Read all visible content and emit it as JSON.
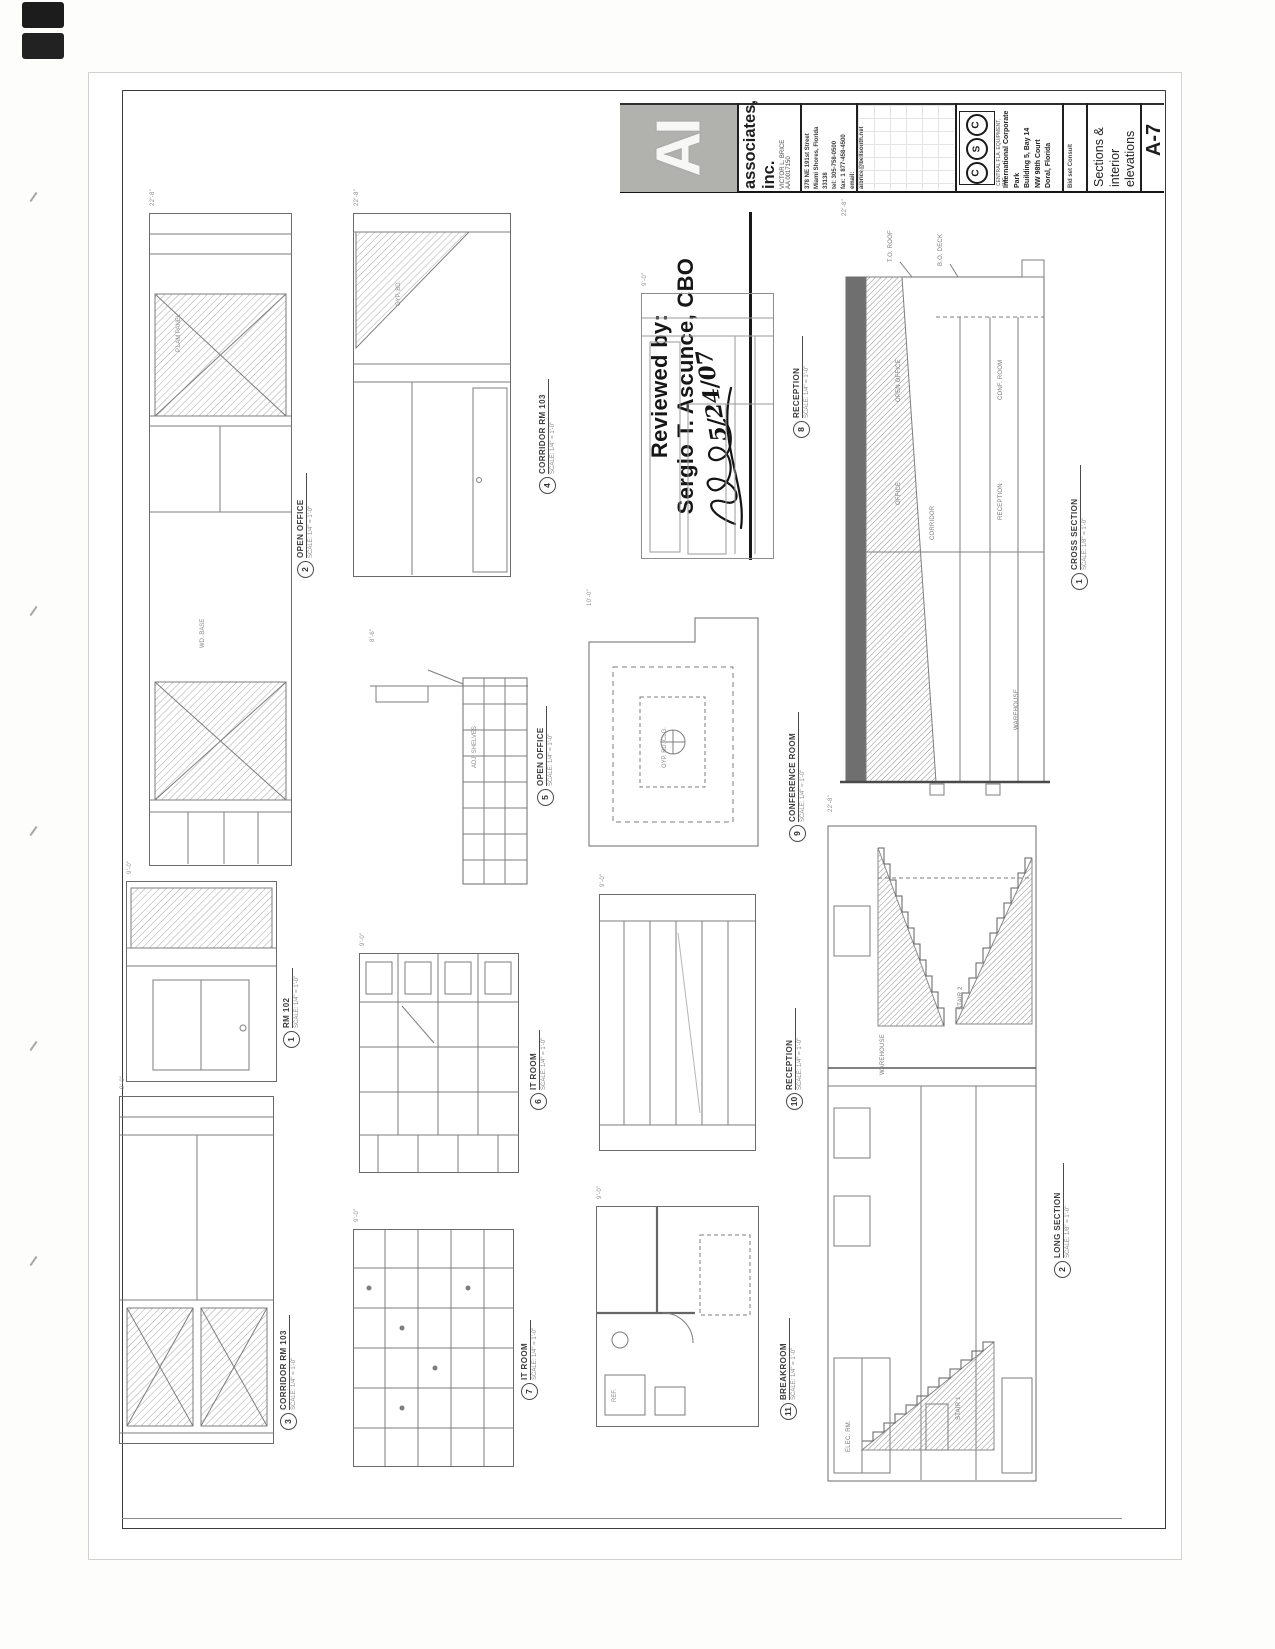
{
  "sheet": {
    "sheet_number": "A-7",
    "sheet_title_lines": [
      "Sections &",
      "interior",
      "elevations"
    ],
    "issue_note": "Bid set  Consult",
    "firm": {
      "logo": "AI",
      "name_top": "associates,",
      "name_bottom": "inc.",
      "principal": "VICTOR L. BRICE",
      "license": "AA 0017150",
      "address_lines": [
        "378 NE 191st Street",
        "Miami Shores, Florida",
        "33138",
        "tel: 305-758-0500",
        "fax: 1 877-458-4500",
        "email:",
        "aibrice@bellsouth.net"
      ]
    },
    "client": {
      "logo_letters": [
        "C",
        "S",
        "C"
      ],
      "logo_caption": "CENTRAL FLA. EQUIPMENT, INC.",
      "project_lines": [
        "International Corporate",
        "Park",
        "Building 5, Bay 14",
        "NW 98th Court",
        "Doral, Florida"
      ]
    }
  },
  "stamp": {
    "line1": "Reviewed by:",
    "line2": "Sergio T. Ascunce, CBO",
    "date": "5/24/07"
  },
  "panels": [
    {
      "num": "2",
      "title": "OPEN OFFICE",
      "scale": "SCALE: 1/4\" = 1'-0\"",
      "tag": "22'-8\"",
      "ann": [
        "P.LAM PANEL",
        "WD. BASE"
      ]
    },
    {
      "num": "1",
      "title": "RM 102",
      "scale": "SCALE: 1/4\" = 1'-0\"",
      "tag": "9'-0\""
    },
    {
      "num": "3",
      "title": "CORRIDOR RM 103",
      "scale": "SCALE: 1/4\" = 1'-0\"",
      "tag": "9'-0\""
    },
    {
      "num": "4",
      "title": "CORRIDOR RM 103",
      "scale": "SCALE: 1/4\" = 1'-0\"",
      "tag": "22'-8\"",
      "ann": [
        "GYP. BD."
      ]
    },
    {
      "num": "5",
      "title": "OPEN OFFICE",
      "scale": "SCALE: 1/4\" = 1'-0\"",
      "tag": "8'-6\"",
      "ann": [
        "ADJ. SHELVES"
      ]
    },
    {
      "num": "6",
      "title": "IT ROOM",
      "scale": "SCALE: 1/4\" = 1'-0\"",
      "tag": "9'-0\""
    },
    {
      "num": "7",
      "title": "IT ROOM",
      "scale": "SCALE: 1/4\" = 1'-0\"",
      "tag": "9'-0\""
    },
    {
      "num": "8",
      "title": "RECEPTION",
      "scale": "SCALE: 1/4\" = 1'-0\"",
      "tag": "9'-0\""
    },
    {
      "num": "9",
      "title": "CONFERENCE ROOM",
      "scale": "SCALE: 1/4\" = 1'-0\"",
      "tag": "10'-0\"",
      "ann": [
        "GYP. BD. CLG."
      ]
    },
    {
      "num": "10",
      "title": "RECEPTION",
      "scale": "SCALE: 1/4\" = 1'-0\"",
      "tag": "9'-0\""
    },
    {
      "num": "11",
      "title": "BREAKROOM",
      "scale": "SCALE: 1/4\" = 1'-0\"",
      "tag": "9'-0\"",
      "ann": [
        "REF."
      ]
    },
    {
      "num": "1",
      "title": "CROSS SECTION",
      "scale": "SCALE: 1/8\" = 1'-0\"",
      "tag": "22'-8\""
    },
    {
      "num": "2",
      "title": "LONG SECTION",
      "scale": "SCALE: 1/8\" = 1'-0\"",
      "tag": "22'-8\""
    }
  ],
  "cross_section": {
    "rooms": [
      "OPEN OFFICE",
      "OFFICE",
      "CORRIDOR",
      "CONF. ROOM",
      "RECEPTION",
      "WAREHOUSE"
    ],
    "notes": [
      "T.O. ROOF",
      "B.O. DECK"
    ]
  },
  "long_section": {
    "rooms": [
      "WAREHOUSE",
      "STAIR 2",
      "ELEC. RM.",
      "STAIR 1"
    ]
  }
}
